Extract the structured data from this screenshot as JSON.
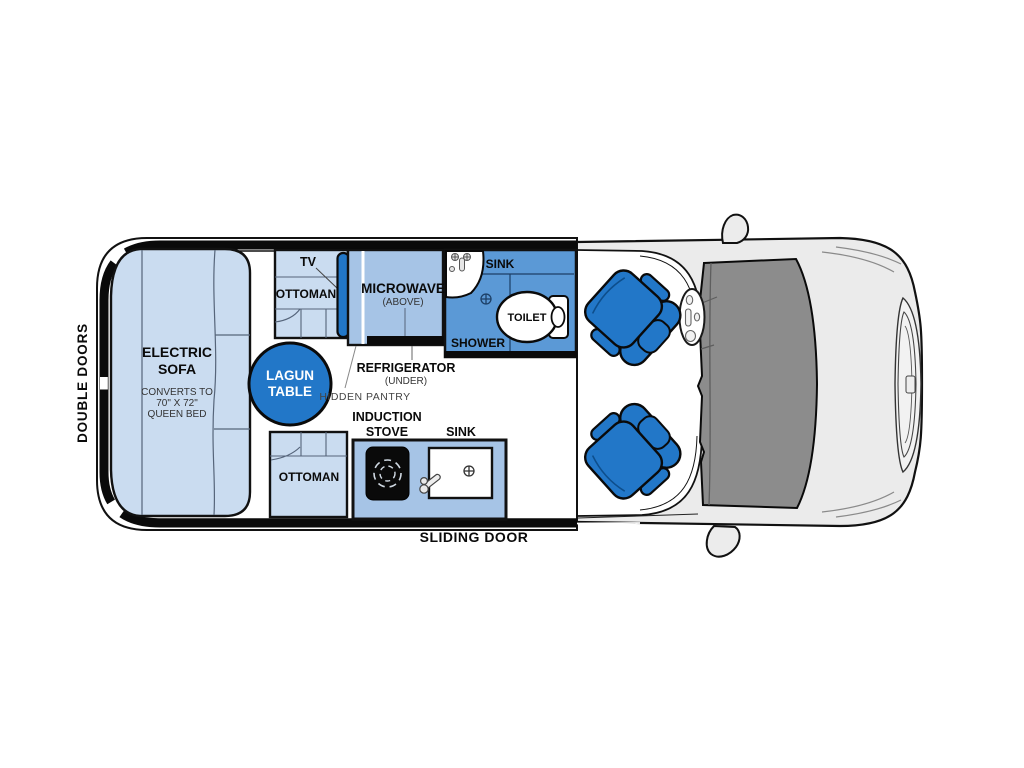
{
  "colors": {
    "accent_blue": "#2277c8",
    "light_blue": "#cadcf0",
    "mid_blue": "#a6c4e6",
    "shower_blue": "#5b99d6",
    "body_gray": "#ebebeb",
    "windshield_gray": "#8c8c8c",
    "wall_black": "#0a0a0a",
    "stove_black": "#0a0a0a"
  },
  "van": {
    "rear_door_label": "DOUBLE DOORS",
    "side_door_label": "SLIDING DOOR"
  },
  "lounge": {
    "sofa_line1": "ELECTRIC",
    "sofa_line2": "SOFA",
    "sofa_note1": "CONVERTS TO",
    "sofa_note2": "70\" X 72\"",
    "sofa_note3": "QUEEN BED",
    "table_line1": "LAGUN",
    "table_line2": "TABLE",
    "tv_label": "TV",
    "ottoman_rear_label": "OTTOMAN",
    "ottoman_front_label": "OTTOMAN"
  },
  "galley": {
    "microwave_label": "MICROWAVE",
    "microwave_note": "(ABOVE)",
    "refrigerator_label": "REFRIGERATOR",
    "refrigerator_note": "(UNDER)",
    "hidden_pantry_label": "HIDDEN PANTRY",
    "stove_line1": "INDUCTION",
    "stove_line2": "STOVE",
    "sink_label": "SINK"
  },
  "bath": {
    "sink_label": "SINK",
    "shower_label": "SHOWER",
    "toilet_label": "TOILET"
  }
}
